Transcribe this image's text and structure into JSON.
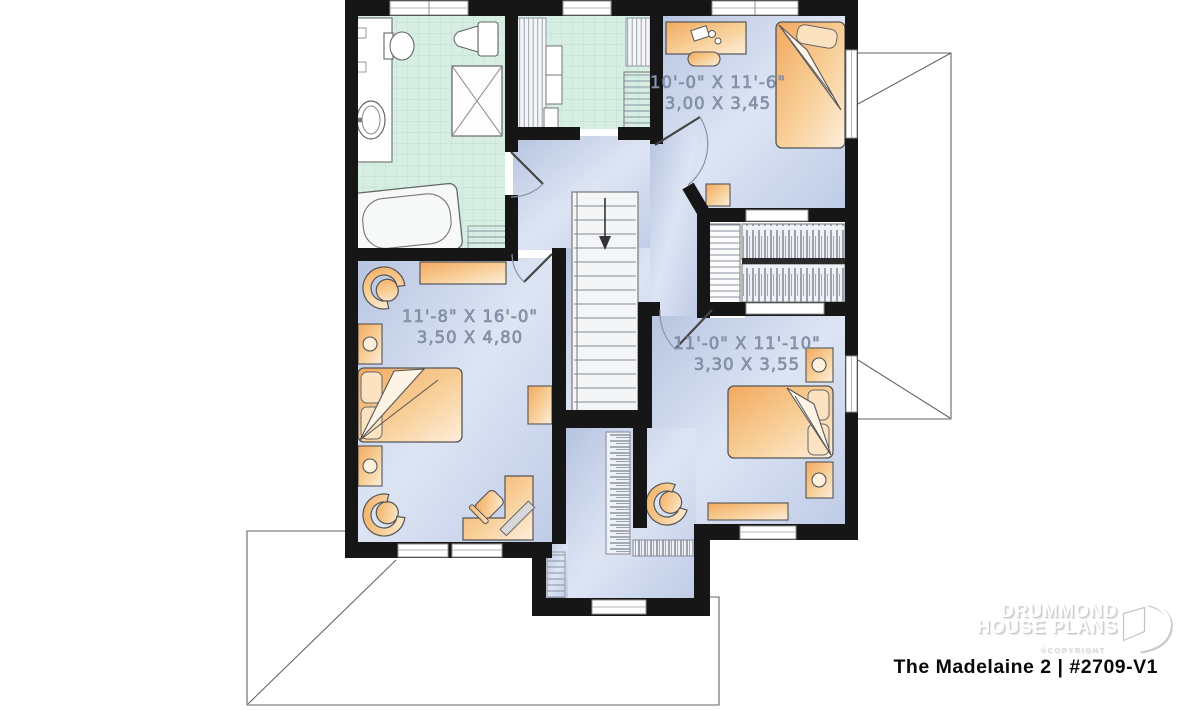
{
  "plan": {
    "rooms": {
      "bedroom1": {
        "imperial": "10'-0\" X 11'-6\"",
        "metric": "3,00 X 3,45"
      },
      "master": {
        "imperial": "11'-8\" X 16'-0\"",
        "metric": "3,50 X 4,80"
      },
      "bedroom2": {
        "imperial": "11'-0\" X 11'-10\"",
        "metric": "3,30 X 3,55"
      }
    },
    "stairs_direction": "down"
  },
  "branding": {
    "name_line1": "DRUMMOND",
    "name_line2": "HOUSE PLANS",
    "copyright": "©COPYRIGHT",
    "plan_title": "The Madelaine 2 | #2709-V1"
  },
  "colors": {
    "wall": "#161616",
    "floor_blue": "#c5d1e9",
    "tile_mint": "#d7eee3",
    "furniture_orange": "#f5b878",
    "label_text": "#8d99af"
  }
}
